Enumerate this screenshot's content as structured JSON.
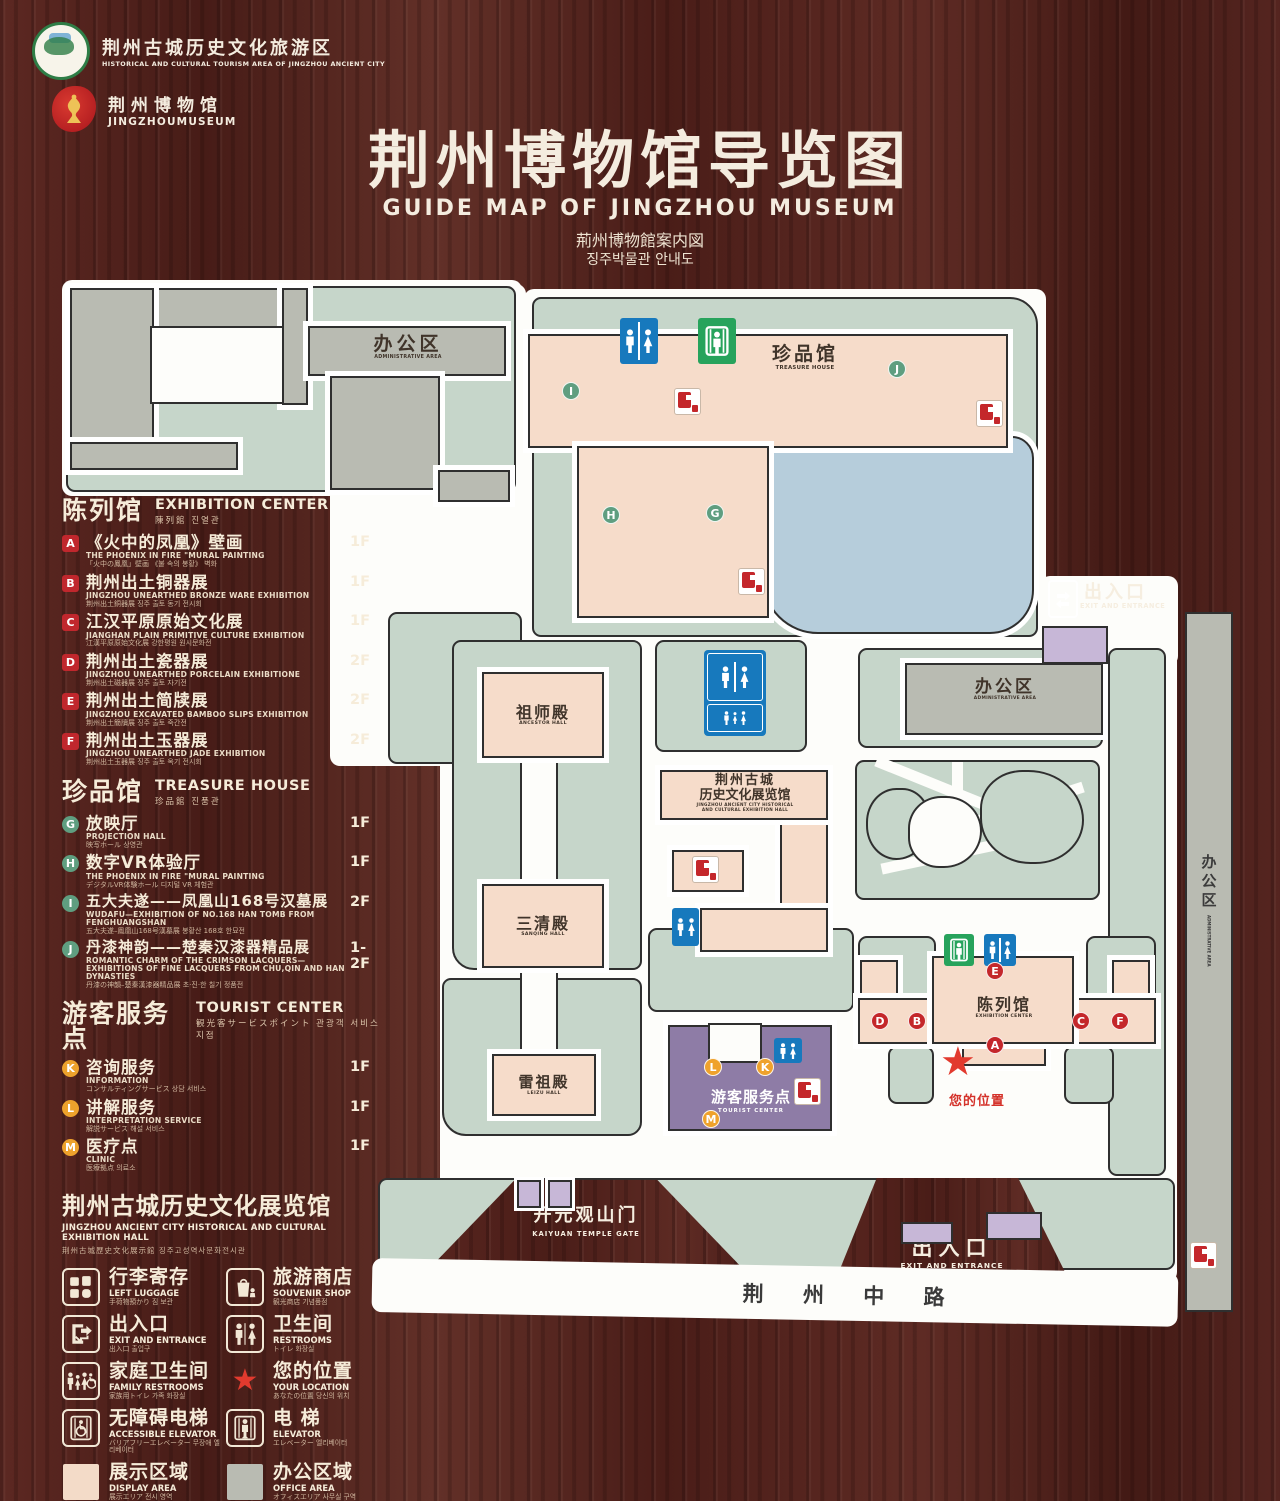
{
  "header": {
    "logo1": {
      "cn": "荆州古城历史文化旅游区",
      "en": "HISTORICAL AND CULTURAL TOURISM AREA OF JINGZHOU ANCIENT CITY"
    },
    "logo2": {
      "cn": "荆州博物馆",
      "en": "JINGZHOUMUSEUM"
    },
    "title": "荆州博物馆导览图",
    "subtitle_en": "GUIDE MAP OF JINGZHOU MUSEUM",
    "subtitle_ja": "荊州博物館案内図",
    "subtitle_ko": "징주박물관 안내도"
  },
  "legend": {
    "ec": {
      "cn": "陈列馆",
      "en": "EXHIBITION CENTER",
      "sub": "陳列館  진열관",
      "items": [
        {
          "letter": "A",
          "cn": "《火中的凤凰》壁画",
          "en": "THE PHOENIX IN FIRE \"MURAL PAINTING",
          "sub": "「火中の鳳凰」壁画 《불 속의 봉황》 벽화",
          "floor": "1F"
        },
        {
          "letter": "B",
          "cn": "荆州出土铜器展",
          "en": "JINGZHOU UNEARTHED BRONZE WARE EXHIBITION",
          "sub": "荆州出土銅器展  징주 출토 동기 전시회",
          "floor": "1F"
        },
        {
          "letter": "C",
          "cn": "江汉平原原始文化展",
          "en": "JIANGHAN PLAIN PRIMITIVE CULTURE EXHIBITION",
          "sub": "江漢平原原始文化展  강한평원 원시문화전",
          "floor": "1F"
        },
        {
          "letter": "D",
          "cn": "荆州出土瓷器展",
          "en": "JINGZHOU UNEARTHED PORCELAIN EXHIBITIONE",
          "sub": "荆州出土磁器展  징주 출토 자기전",
          "floor": "2F"
        },
        {
          "letter": "E",
          "cn": "荆州出土简牍展",
          "en": "JINGZHOU EXCAVATED BAMBOO SLIPS EXHIBITION",
          "sub": "荆州出土簡牘展  징주 출토 죽간전",
          "floor": "2F"
        },
        {
          "letter": "F",
          "cn": "荆州出土玉器展",
          "en": "JINGZHOU UNEARTHED JADE EXHIBITION",
          "sub": "荆州出土玉器展  징주 출토 옥기 전시회",
          "floor": "2F"
        }
      ]
    },
    "th": {
      "cn": "珍品馆",
      "en": "TREASURE HOUSE",
      "sub": "珍品館  진품관",
      "items": [
        {
          "letter": "G",
          "cn": "放映厅",
          "en": "PROJECTION HALL",
          "sub": "映写ホール  상영관",
          "floor": "1F"
        },
        {
          "letter": "H",
          "cn": "数字VR体验厅",
          "en": "THE PHOENIX IN FIRE \"MURAL PAINTING",
          "sub": "デジタルVR体験ホール  디지털 VR 체험관",
          "floor": "1F"
        },
        {
          "letter": "I",
          "cn": "五大夫遂——凤凰山168号汉墓展",
          "en": "WUDAFU—EXHIBITION OF NO.168 HAN TOMB FROM FENGHUANGSHAN",
          "sub": "五大夫遂–鳳凰山168号漢墓展  봉황산 168호 한묘전",
          "floor": "2F"
        },
        {
          "letter": "J",
          "cn": "丹漆神韵——楚秦汉漆器精品展",
          "en": "ROMANTIC CHARM OF THE CRIMSON LACQUERS— EXHIBITIONS OF FINE LACQUERS FROM CHU,QIN AND HAN DYNASTIES",
          "sub": "丹漆の神韻–楚秦漢漆器精品展  초·진·한 칠기 정품전",
          "floor": "1-2F"
        }
      ]
    },
    "tc": {
      "cn": "游客服务点",
      "en": "TOURIST CENTER",
      "sub": "観光客サービスポイント  관광객 서비스 지점",
      "items": [
        {
          "letter": "K",
          "cn": "咨询服务",
          "en": "INFORMATION",
          "sub": "コンサルティングサービス  상담 서비스",
          "floor": "1F"
        },
        {
          "letter": "L",
          "cn": "讲解服务",
          "en": "INTERPRETATION SERVICE",
          "sub": "解説サービス  해설 서비스",
          "floor": "1F"
        },
        {
          "letter": "M",
          "cn": "医疗点",
          "en": "CLINIC",
          "sub": "医療拠点  의료소",
          "floor": "1F"
        }
      ]
    },
    "hall": {
      "cn": "荆州古城历史文化展览馆",
      "en": "JINGZHOU ANCIENT CITY HISTORICAL AND CULTURAL EXHIBITION HALL",
      "sub": "荆州古城歴史文化展示館    징주고성역사문화전시관"
    },
    "icons": [
      {
        "cn": "行李寄存",
        "en": "LEFT LUGGAGE",
        "sub": "手荷物預かり  짐 보관"
      },
      {
        "cn": "旅游商店",
        "en": "SOUVENIR SHOP",
        "sub": "観光商店  기념품점"
      },
      {
        "cn": "出入口",
        "en": "EXIT AND ENTRANCE",
        "sub": "出入口  출입구"
      },
      {
        "cn": "卫生间",
        "en": "RESTROOMS",
        "sub": "トイレ  화장실"
      },
      {
        "cn": "家庭卫生间",
        "en": "FAMILY RESTROOMS",
        "sub": "家族用トイレ  가족 화장실"
      },
      {
        "cn": "您的位置",
        "en": "YOUR LOCATION",
        "sub": "あなたの位置  당신의 위치"
      },
      {
        "cn": "无障碍电梯",
        "en": "ACCESSIBLE ELEVATOR",
        "sub": "バリアフリーエレベーター  무장애 엘리베이터"
      },
      {
        "cn": "电  梯",
        "en": "ELEVATOR",
        "sub": "エレベーター  엘리베이터"
      },
      {
        "cn": "展示区域",
        "en": "DISPLAY AREA",
        "sub": "展示エリア  전시 영역"
      },
      {
        "cn": "办公区域",
        "en": "OFFICE AREA",
        "sub": "オフィスエリア  사무실 구역"
      }
    ]
  },
  "map": {
    "admin_tl": {
      "cn": "办公区",
      "en": "ADMINISTRATIVE AREA"
    },
    "treasure": {
      "cn": "珍品馆",
      "en": "TREASURE HOUSE"
    },
    "ancestor": {
      "cn": "祖师殿",
      "en": "ANCESTOR HALL"
    },
    "sanqing": {
      "cn": "三清殿",
      "en": "SANQING HALL"
    },
    "leizu": {
      "cn": "雷祖殿",
      "en": "LEIZU HALL"
    },
    "exhibition_hall": {
      "cn1": "荆州古城",
      "cn2": "历史文化展览馆",
      "en1": "JINGZHOU ANCIENT CITY HISTORICAL",
      "en2": "AND CULTURAL EXHIBITION HALL"
    },
    "admin_r": {
      "cn": "办公区",
      "en": "ADMINISTRATIVE AREA"
    },
    "admin_strip": {
      "cn": "办公区",
      "en": "ADMINISTRATIVE AREA"
    },
    "exh_center": {
      "cn": "陈列馆",
      "en": "EXHIBITION CENTER"
    },
    "tourist": {
      "cn": "游客服务点",
      "en": "TOURIST CENTER"
    },
    "exit_east": {
      "cn": "出入口",
      "en": "EXIT AND ENTRANCE"
    },
    "exit_south": {
      "cn": "出入口",
      "en": "EXIT AND ENTRANCE"
    },
    "gate": {
      "cn": "开元观山门",
      "en": "KAIYUAN TEMPLE GATE"
    },
    "your_location": "您的位置",
    "road": "荆 州 中 路",
    "markers": {
      "i": "I",
      "j": "J",
      "h": "H",
      "g": "G",
      "e": "E",
      "d": "D",
      "b": "B",
      "c": "C",
      "f": "F",
      "a": "A",
      "k": "K",
      "l": "L",
      "m": "M"
    }
  }
}
